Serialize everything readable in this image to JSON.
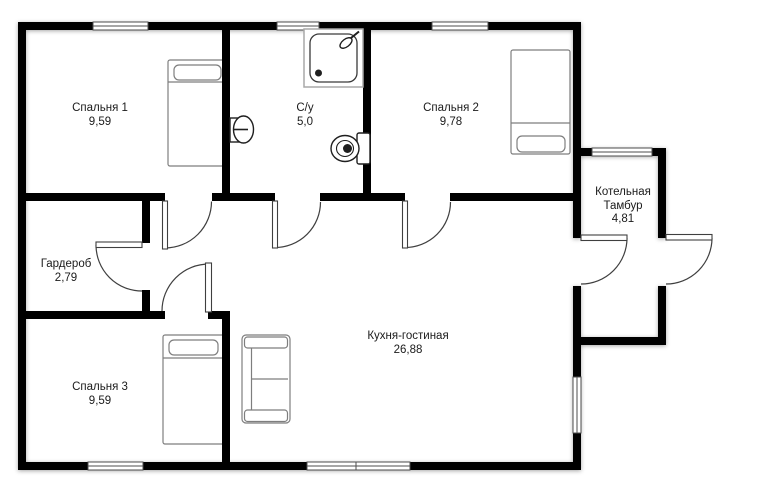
{
  "rooms": {
    "bedroom1": {
      "name": "Спальня 1",
      "area": "9,59"
    },
    "bathroom": {
      "name": "С/у",
      "area": "5,0"
    },
    "bedroom2": {
      "name": "Спальня 2",
      "area": "9,78"
    },
    "boiler_vestibule": {
      "name": "Котельная",
      "name2": "Тамбур",
      "area": "4,81"
    },
    "wardrobe": {
      "name": "Гардероб",
      "area": "2,79"
    },
    "kitchen_living": {
      "name": "Кухня-гостиная",
      "area": "26,88"
    },
    "bedroom3": {
      "name": "Спальня 3",
      "area": "9,59"
    }
  },
  "colors": {
    "wall": "#000000",
    "door_line": "#3f3f3f",
    "window_line": "#4d4d4d",
    "furniture_line": "#7e7e7e",
    "fixture_line": "#1f1f1f",
    "text": "#1b1b1b",
    "background": "#ffffff"
  }
}
